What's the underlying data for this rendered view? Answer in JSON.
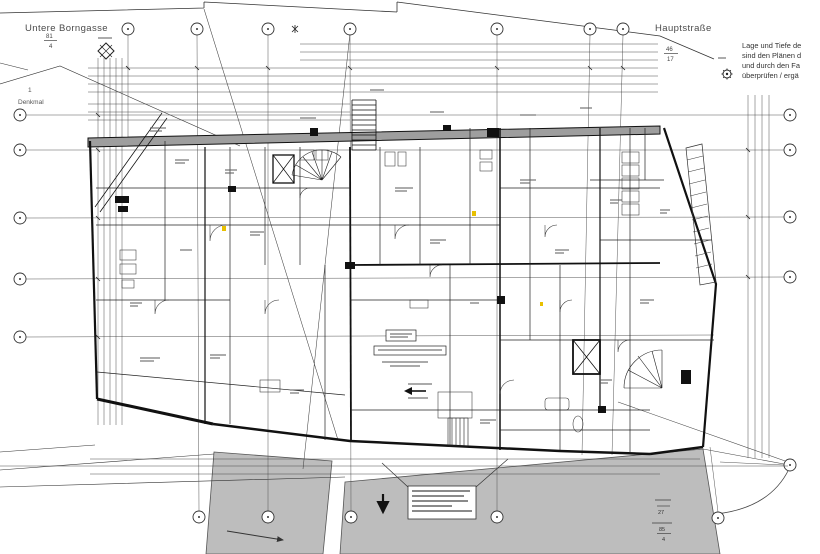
{
  "streets": {
    "top_left": "Untere Borngasse",
    "top_right": "Hauptstraße"
  },
  "parcel": {
    "denkmal": "Denkmal",
    "denkmal_no": "1"
  },
  "note_block": {
    "lines": [
      "Lage und Tiefe de",
      "sind den Plänen d",
      "und durch den Fa",
      "überprüfen / ergä"
    ]
  },
  "dimensions": {
    "top_left_fraction": {
      "num": "81",
      "den": "4"
    },
    "top_right_fraction": {
      "num": "46",
      "den": "17"
    },
    "bottom_right_no": "27",
    "bottom_right_fraction": {
      "num": "85",
      "den": "4"
    }
  },
  "colors": {
    "line": "#1b1b1b",
    "street_fill": "#bdbdbd",
    "wall_fill": "#9e9e9e",
    "highlight": "#e8c000"
  }
}
